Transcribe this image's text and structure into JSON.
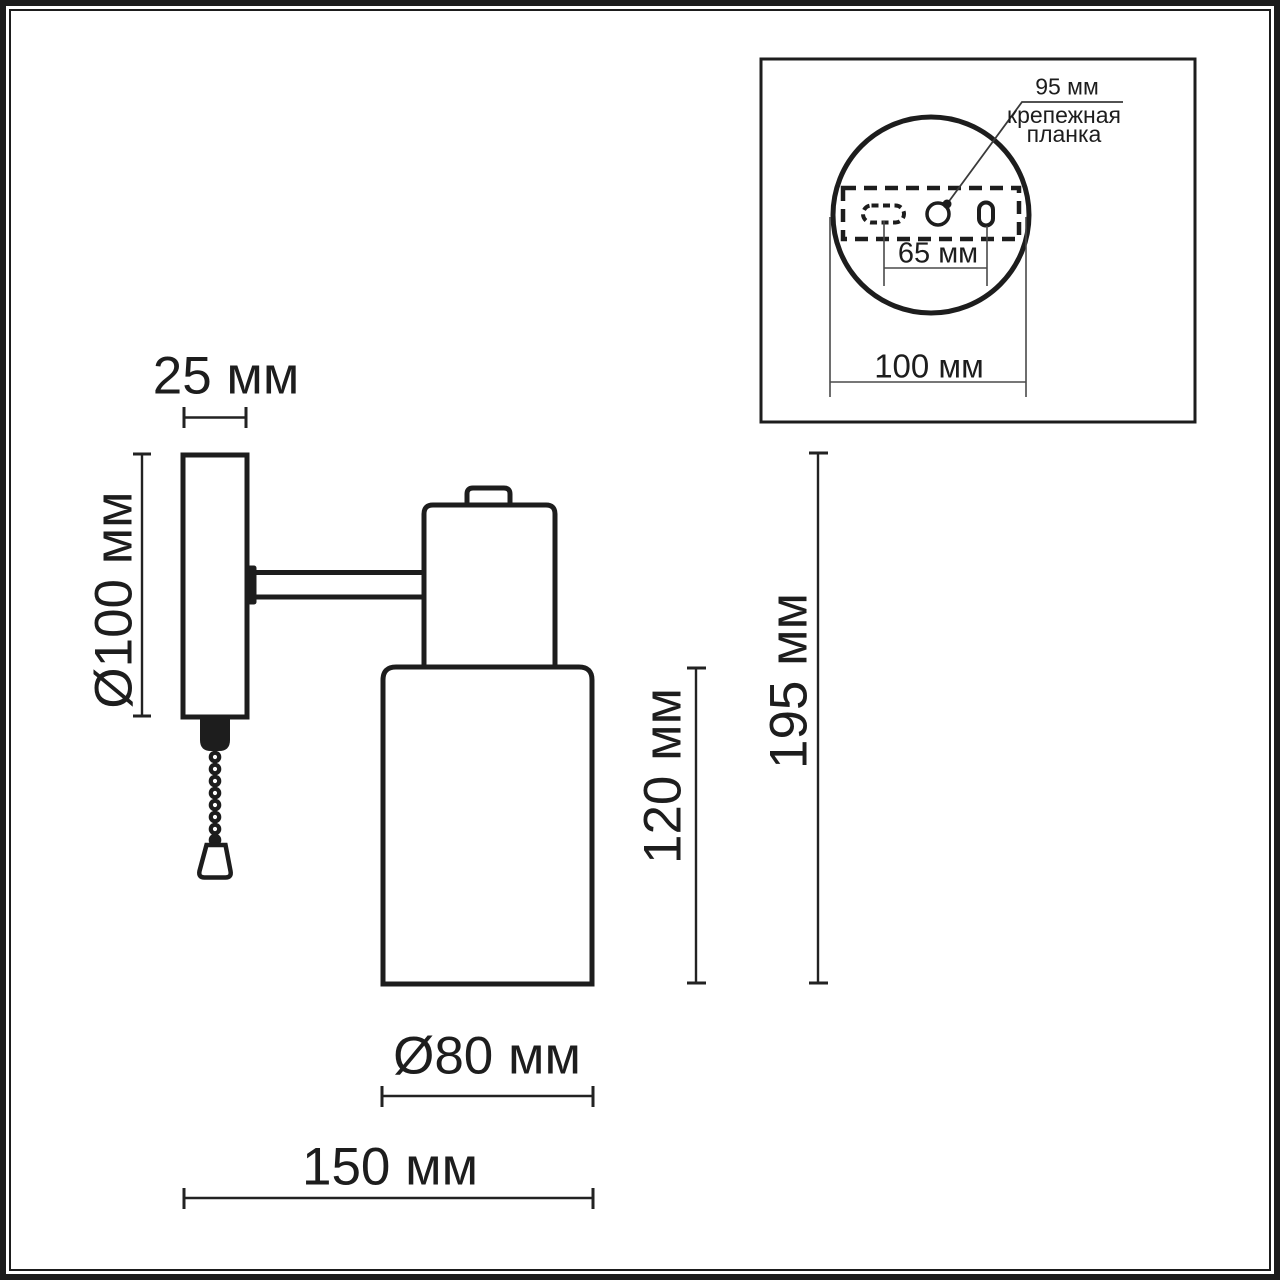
{
  "main_view": {
    "labels": {
      "plate_width": "25 мм",
      "plate_diameter": "Ø100 мм",
      "shade_height": "120 мм",
      "total_height": "195 мм",
      "shade_diameter": "Ø80 мм",
      "total_depth": "150 мм"
    }
  },
  "inset_view": {
    "labels": {
      "bracket_width": "95 мм",
      "bracket_name_line1": "крепежная",
      "bracket_name_line2": "планка",
      "hole_spacing": "65 мм",
      "base_diameter": "100 мм"
    }
  },
  "colors": {
    "line": "#1d1d1d",
    "thin_line": "#4a4a4a",
    "background": "#ffffff"
  }
}
